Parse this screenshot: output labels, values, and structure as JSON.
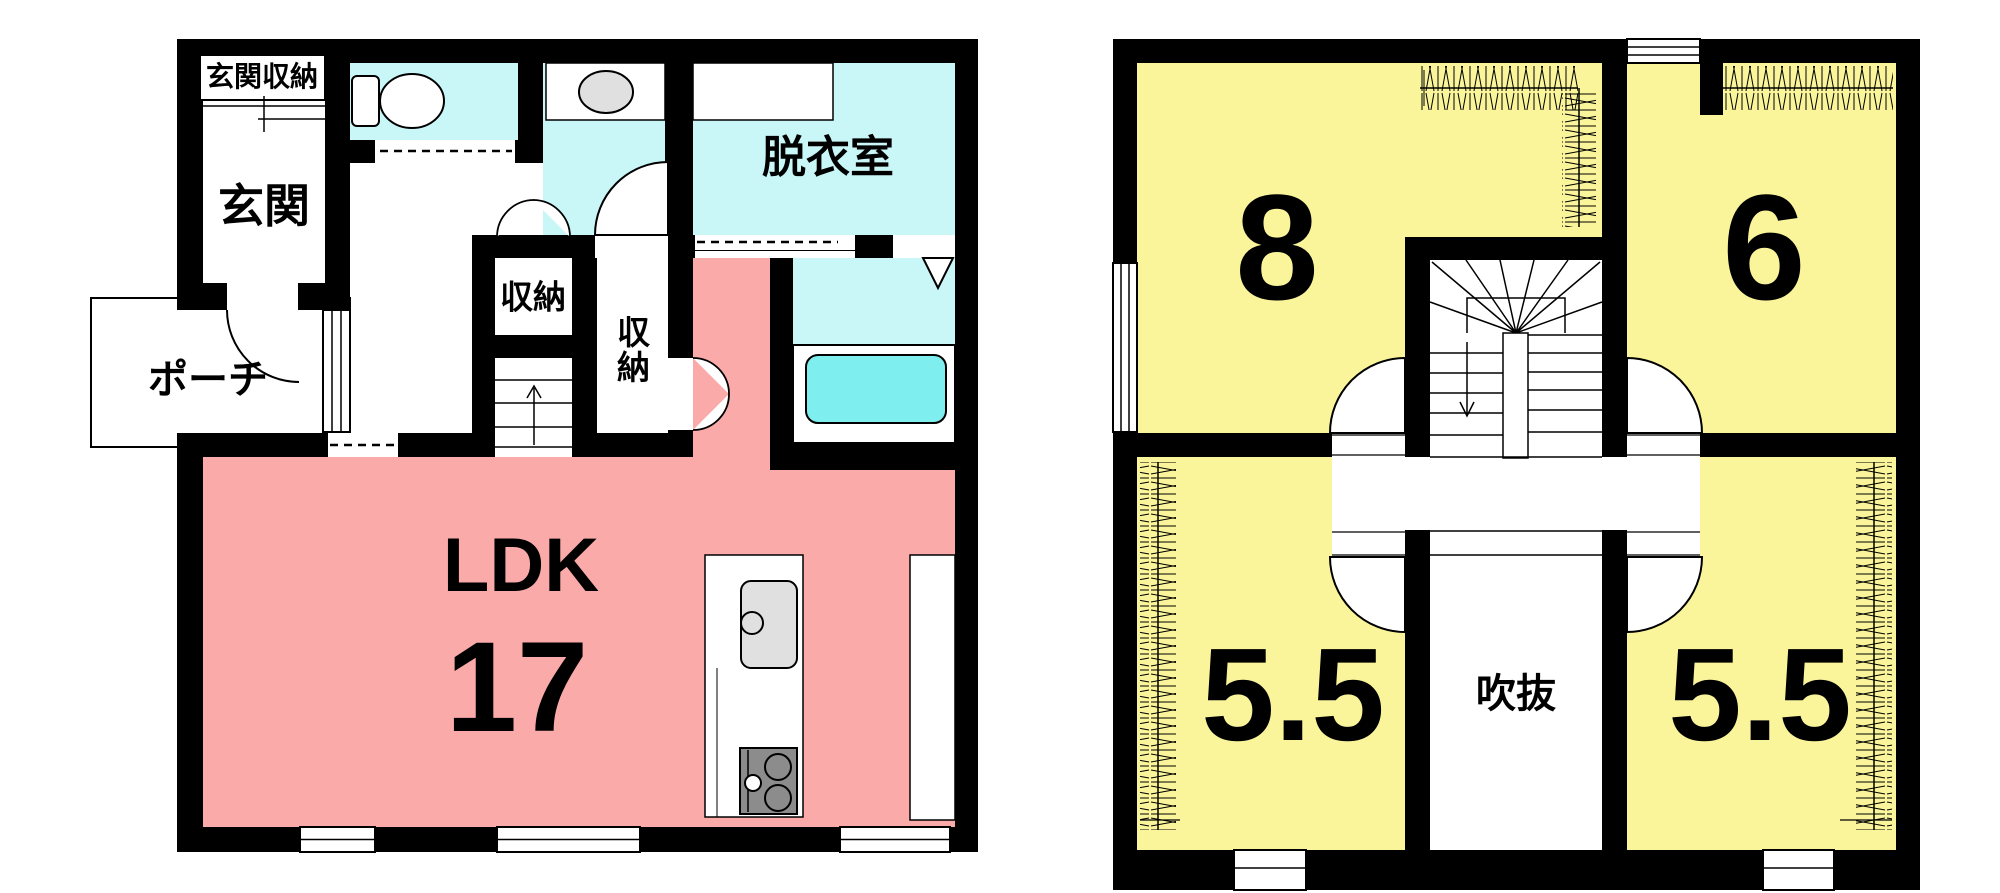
{
  "palette": {
    "wall_black": "#000000",
    "ldk_pink": "#FBAAAA",
    "wet_area_cyan": "#C9F6F7",
    "bathtub_cyan": "#7FEEEE",
    "room_yellow": "#FAF59B",
    "fixture_gray": "#E0E0E0",
    "stove_gray": "#8C8C8C",
    "floor_white": "#FFFFFF"
  },
  "floor1": {
    "rooms": {
      "entrance_storage": {
        "label": "玄関収納"
      },
      "entrance": {
        "label": "玄関"
      },
      "porch": {
        "label": "ポーチ"
      },
      "dressing_room": {
        "label": "脱衣室"
      },
      "storage_1": {
        "label": "収納"
      },
      "storage_2": {
        "label": "収納"
      },
      "ldk": {
        "label": "LDK",
        "size": "17"
      }
    }
  },
  "floor2": {
    "rooms": {
      "room_8": {
        "size": "8"
      },
      "room_6": {
        "size": "6"
      },
      "room_55_left": {
        "size": "5.5"
      },
      "room_55_right": {
        "size": "5.5"
      },
      "atrium": {
        "label": "吹抜"
      }
    }
  }
}
